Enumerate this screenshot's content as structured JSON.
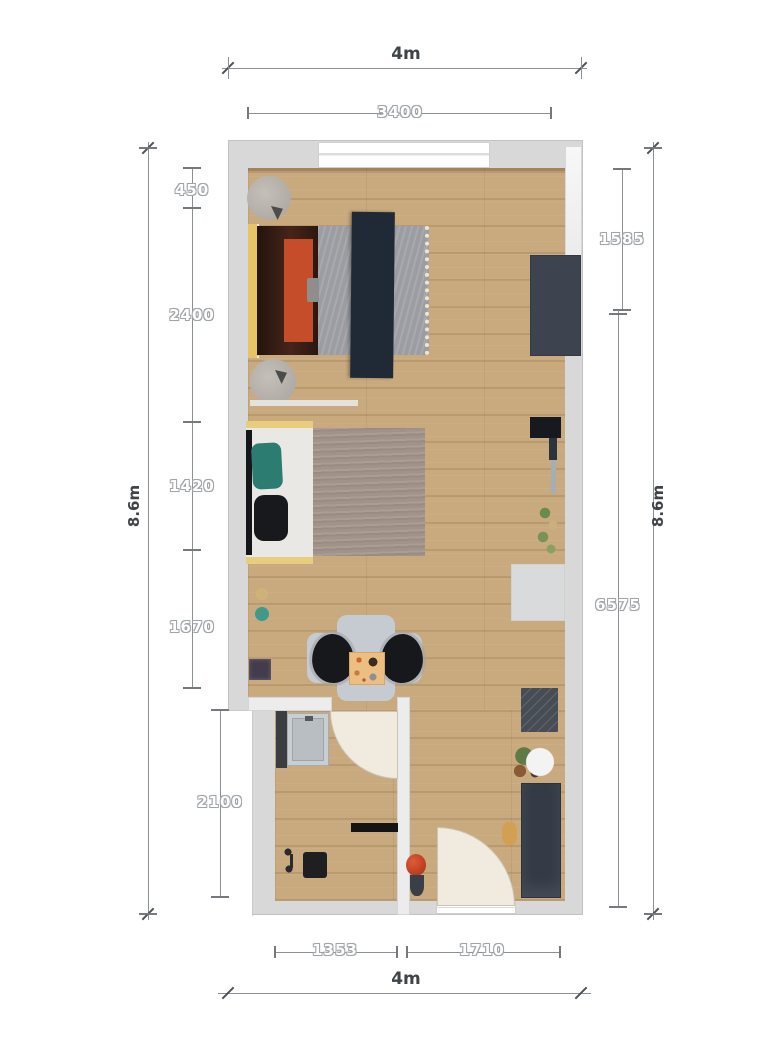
{
  "dims": {
    "top_outer": "4m",
    "top_inner": "3400",
    "left_outer": "8.6m",
    "right_outer": "8.6m",
    "left_1": "450",
    "left_2": "2400",
    "left_3": "1420",
    "left_4": "1670",
    "left_5": "2100",
    "right_1": "1585",
    "right_2": "6575",
    "bottom_1": "1353",
    "bottom_2": "1710",
    "bottom_outer": "4m"
  },
  "colors": {
    "wall": "#d8d8d8",
    "floor": "#c9aa7e",
    "wardrobe": "#3d4450",
    "headboard_yellow": "#e8c466",
    "blanket_orange": "#c64d29",
    "runner_navy": "#202a36",
    "duvet_gray": "#9b9da2",
    "sofa_trim_yellow": "#e9cd7e",
    "pillow_teal": "#2c7c72",
    "rug_brown": "#a2938a",
    "door_cream": "#f0eadf",
    "vanity_dark": "#343b47",
    "dim_line": "#8b9095",
    "dim_text_outline": "#9fa4a8",
    "dim_text_dark": "#3f4448"
  }
}
